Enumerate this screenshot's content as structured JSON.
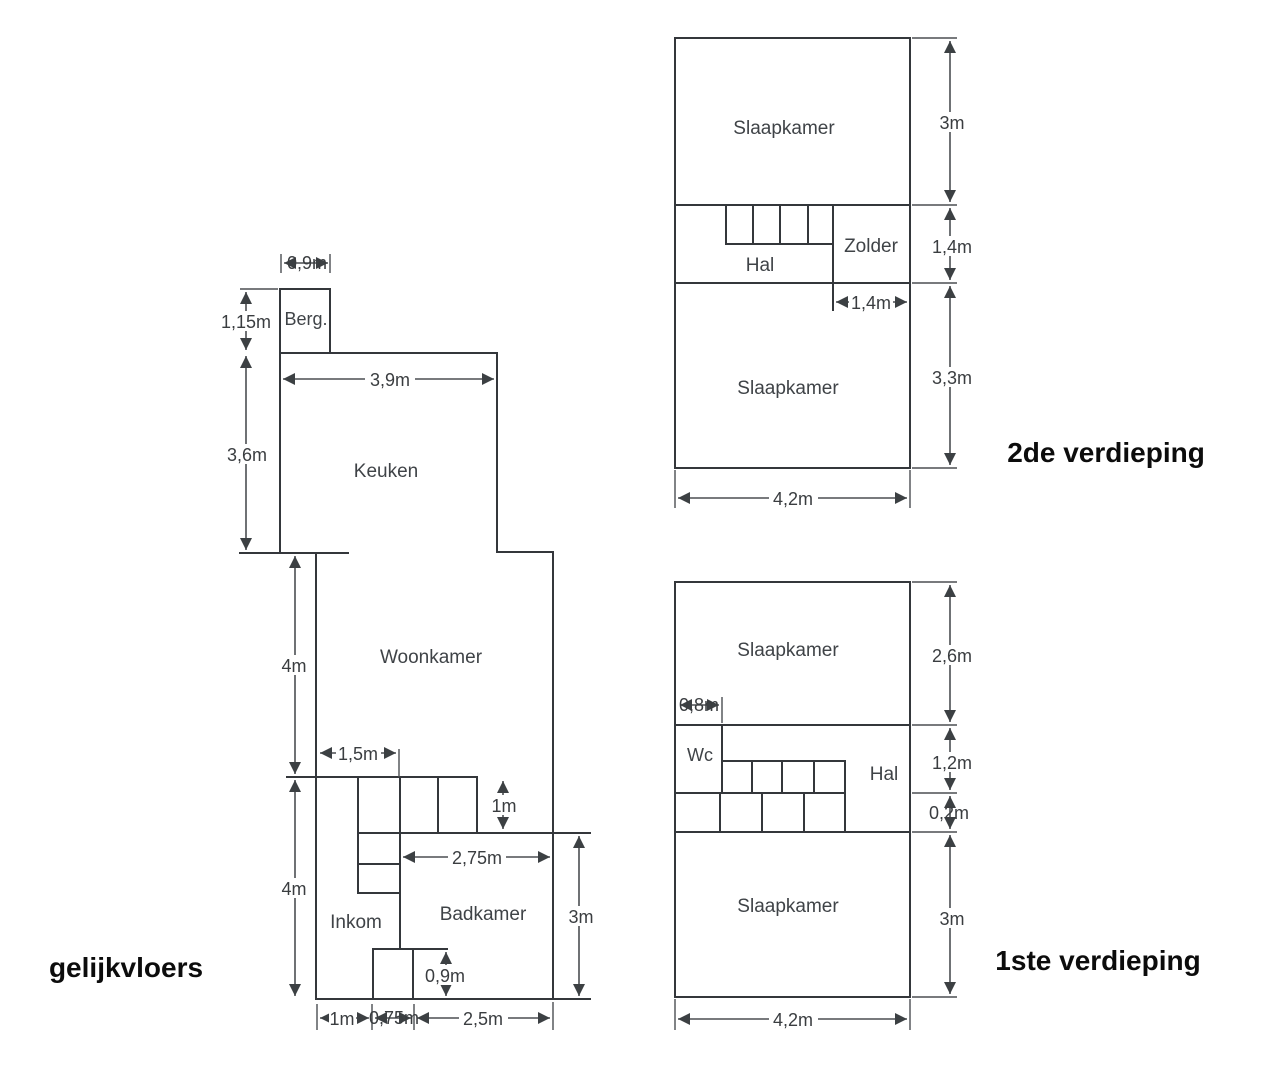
{
  "diagram": {
    "background": "#ffffff",
    "line_color": "#3c4043",
    "label_color": "#3f4347",
    "title_color": "#0c0c0c"
  },
  "ground_floor": {
    "title": "gelijkvloers",
    "rooms": {
      "berg": "Berg.",
      "keuken": "Keuken",
      "woonkamer": "Woonkamer",
      "inkom": "Inkom",
      "badkamer": "Badkamer"
    },
    "dims": {
      "berg_width": "0,9m",
      "berg_height": "1,15m",
      "keuken_width": "3,9m",
      "keuken_height": "3,6m",
      "woonkamer_height": "4m",
      "stair_width": "1,5m",
      "stair_depth": "1m",
      "badkamer_width": "2,75m",
      "inkom_height": "4m",
      "badkamer_height": "3m",
      "door_height": "0,9m",
      "bottom_left": "1m",
      "bottom_middle": "0,75m",
      "bottom_right": "2,5m"
    }
  },
  "second_floor": {
    "title": "2de verdieping",
    "rooms": {
      "slaapkamer_top": "Slaapkamer",
      "hal": "Hal",
      "zolder": "Zolder",
      "slaapkamer_bottom": "Slaapkamer"
    },
    "dims": {
      "top_height": "3m",
      "hal_height": "1,4m",
      "zolder_width": "1,4m",
      "bottom_height": "3,3m",
      "width": "4,2m"
    }
  },
  "first_floor": {
    "title": "1ste verdieping",
    "rooms": {
      "slaapkamer_top": "Slaapkamer",
      "wc": "Wc",
      "hal": "Hal",
      "slaapkamer_bottom": "Slaapkamer"
    },
    "dims": {
      "top_height": "2,6m",
      "wc_width": "0,8m",
      "hal_height": "1,2m",
      "landing_height": "0,2m",
      "bottom_height": "3m",
      "width": "4,2m"
    }
  }
}
